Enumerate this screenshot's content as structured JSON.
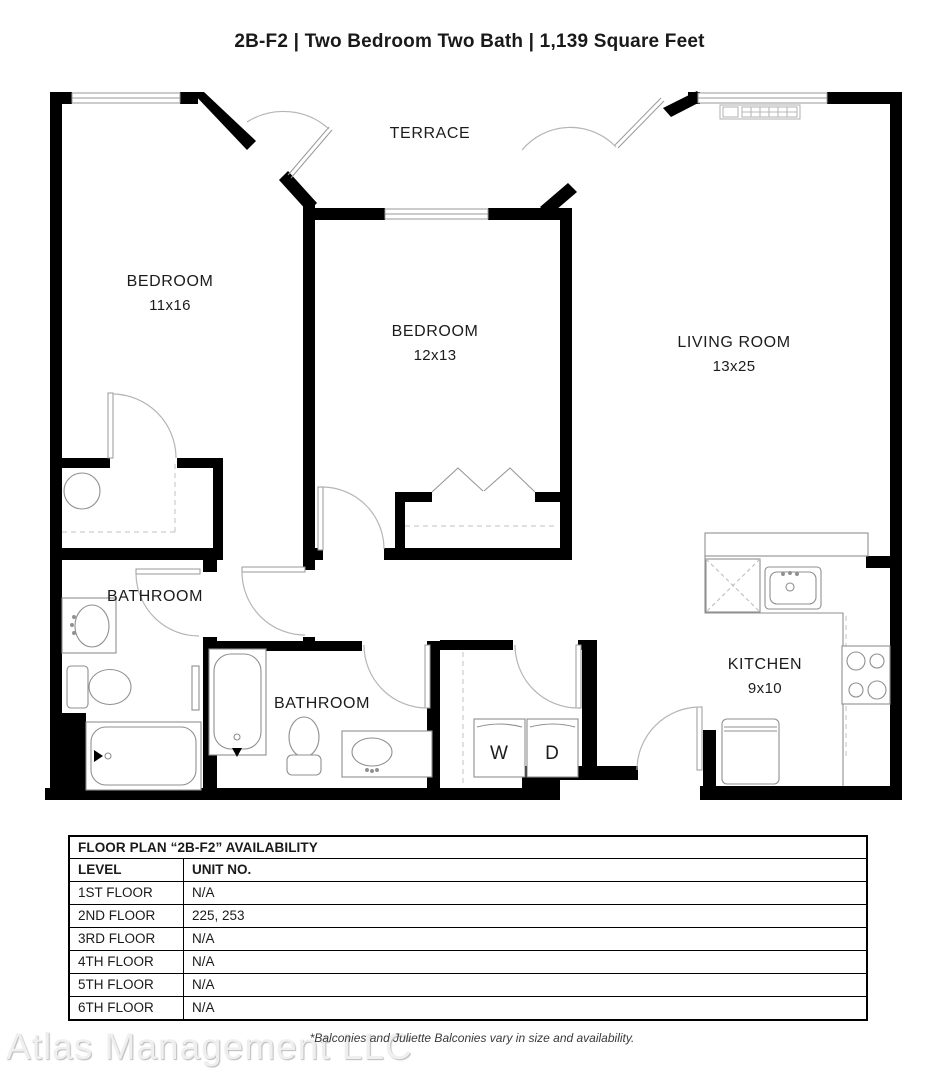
{
  "title": "2B-F2 | Two Bedroom Two Bath | 1,139 Square Feet",
  "floor_plan": {
    "rooms": [
      {
        "label": "TERRACE",
        "dims": ""
      },
      {
        "label": "BEDROOM",
        "dims": "11x16"
      },
      {
        "label": "BEDROOM",
        "dims": "12x13"
      },
      {
        "label": "LIVING ROOM",
        "dims": "13x25"
      },
      {
        "label": "BATHROOM",
        "dims": ""
      },
      {
        "label": "BATHROOM",
        "dims": ""
      },
      {
        "label": "KITCHEN",
        "dims": "9x10"
      }
    ],
    "laundry": {
      "washer": "W",
      "dryer": "D"
    },
    "wall_color": "#000000",
    "fixture_color": "#8f8f8f"
  },
  "availability_table": {
    "title": "FLOOR PLAN “2B-F2” AVAILABILITY",
    "columns": [
      "LEVEL",
      "UNIT NO."
    ],
    "rows": [
      [
        "1ST FLOOR",
        "N/A"
      ],
      [
        "2ND FLOOR",
        "225, 253"
      ],
      [
        "3RD FLOOR",
        "N/A"
      ],
      [
        "4TH FLOOR",
        "N/A"
      ],
      [
        "5TH FLOOR",
        "N/A"
      ],
      [
        "6TH FLOOR",
        "N/A"
      ]
    ]
  },
  "footnote": "*Balconies and Juliette Balconies vary in size and availability.",
  "watermark": "Atlas Management LLC"
}
